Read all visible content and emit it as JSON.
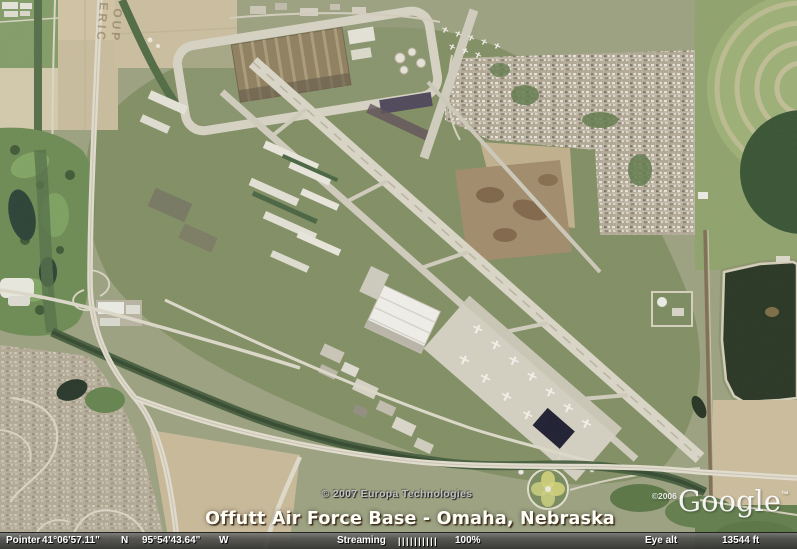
{
  "overlay": {
    "imagery_copyright": "© 2007 Europa Technologies",
    "caption": "Offutt Air Force Base - Omaha, Nebraska",
    "google_copyright": "©2006",
    "google_logo_text": "Google",
    "google_trademark": "™",
    "ground_watermark_line1": "ERIC",
    "ground_watermark_line2": "OUP"
  },
  "status_bar": {
    "pointer_label": "Pointer",
    "latitude": "41°06'57.11\"",
    "latitude_hemisphere": "N",
    "longitude": "95°54'43.64\"",
    "longitude_hemisphere": "W",
    "streaming_label": "Streaming",
    "streaming_bars": "||||||||||",
    "streaming_percent": "100%",
    "eye_alt_label": "Eye alt",
    "eye_alt_value": "13544 ft"
  },
  "colors": {
    "caption_text": "#fffef6",
    "copyright_text": "#c3c3c5",
    "status_bar_text": "#ffffff",
    "status_bar_background": "#4a4a48"
  }
}
